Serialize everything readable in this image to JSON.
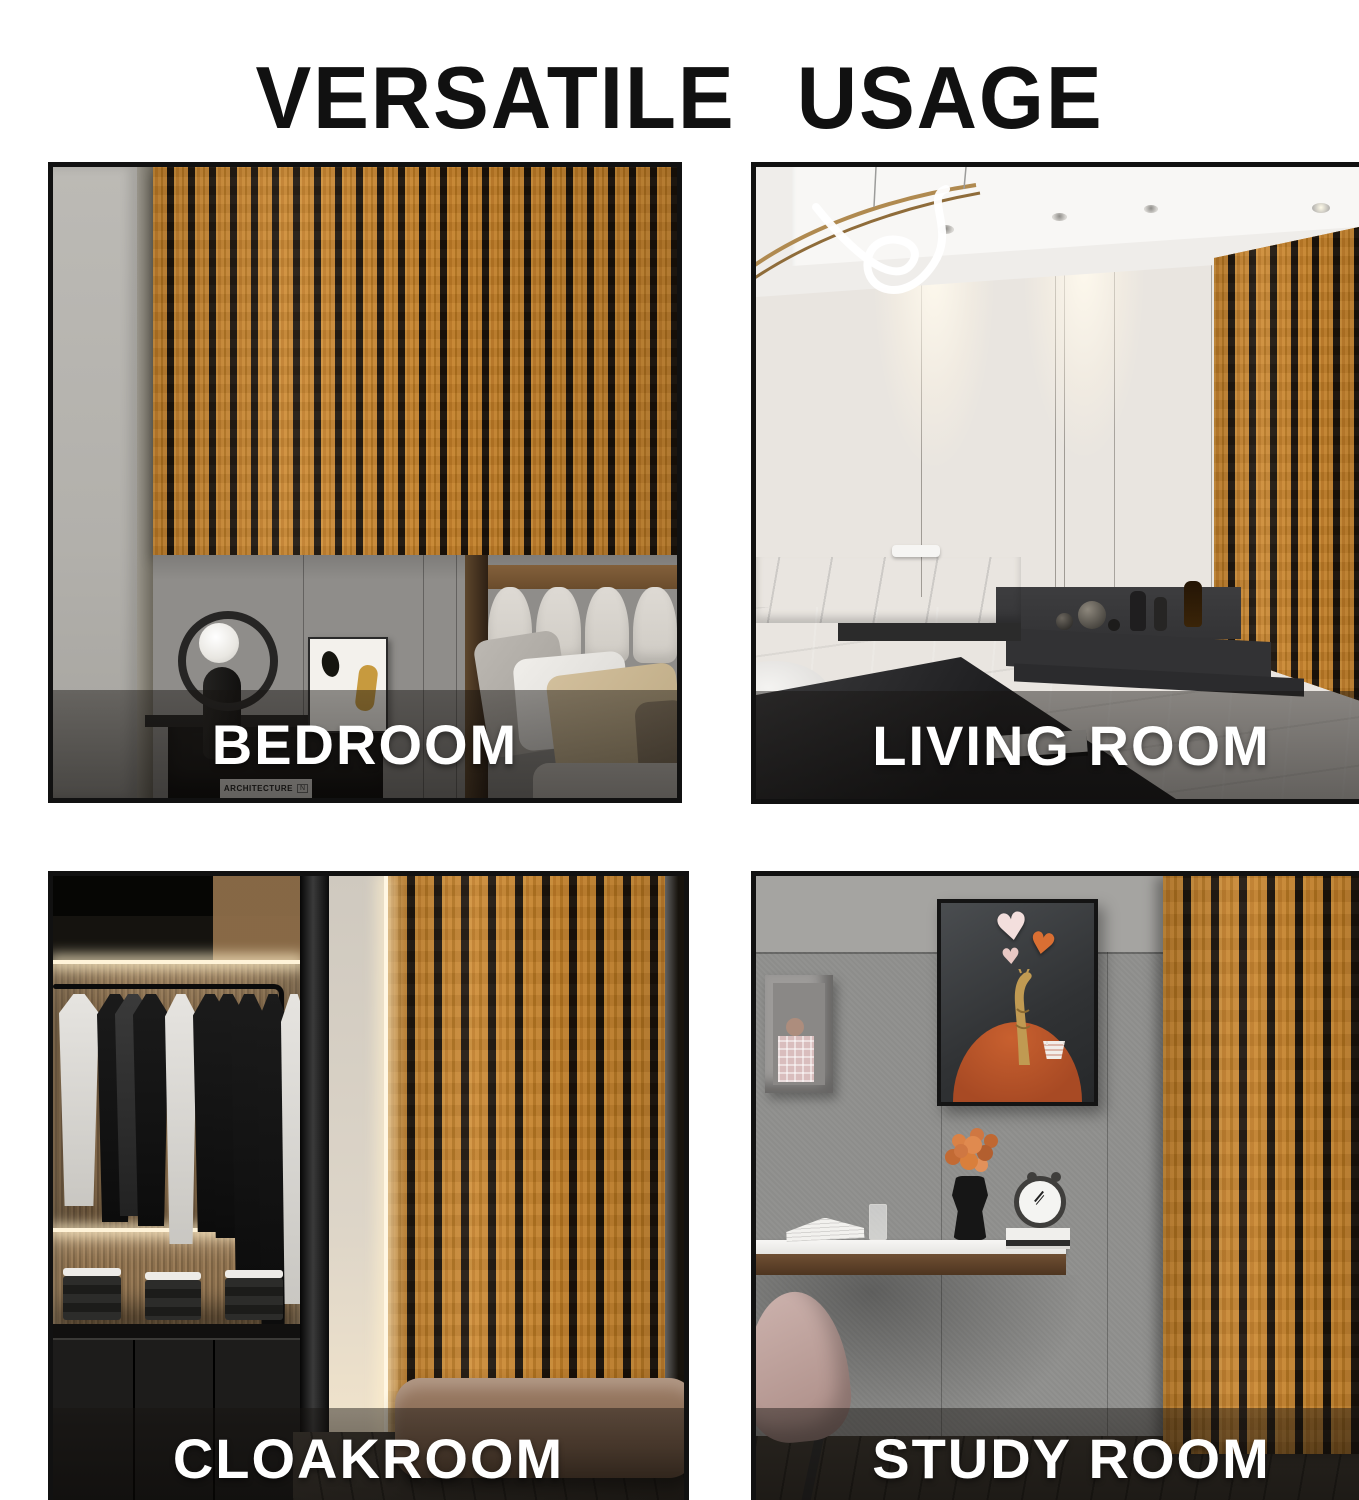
{
  "page": {
    "title": "VERSATILE USAGE",
    "background": "#ffffff",
    "title_color": "#111111"
  },
  "colors": {
    "wood_slat": "#c5832f",
    "slat_gap": "#1a1209",
    "photo_border": "#111111",
    "label_text": "#ffffff",
    "label_band": "rgba(18,15,12,0.52)"
  },
  "panels": [
    {
      "id": "bedroom",
      "label": "BEDROOM"
    },
    {
      "id": "living-room",
      "label": "LIVING ROOM"
    },
    {
      "id": "cloakroom",
      "label": "CLOAKROOM"
    },
    {
      "id": "study-room",
      "label": "STUDY ROOM"
    }
  ],
  "bedroom": {
    "book_title": "ARCHITECTURE",
    "book_mark": "N"
  }
}
